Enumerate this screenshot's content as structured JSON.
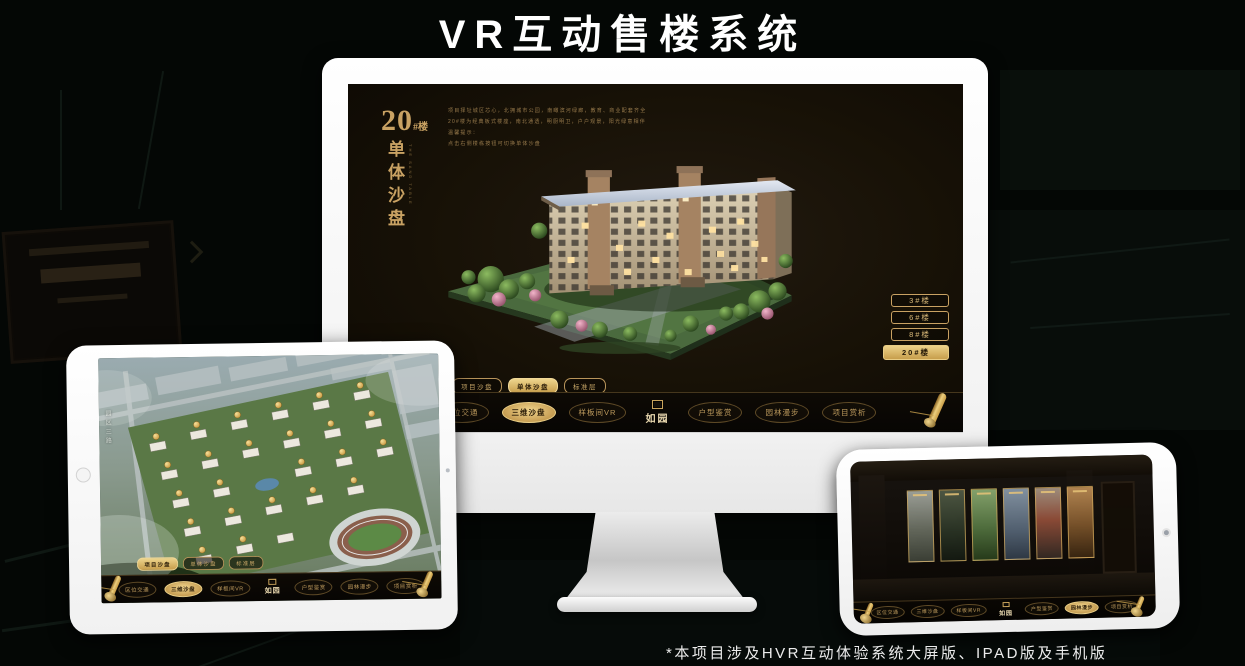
{
  "page": {
    "title": "VR互动售楼系统",
    "footnote": "*本项目涉及HVR互动体验系统大屏版、IPAD版及手机版"
  },
  "brand": {
    "logo_text": "如园",
    "gold": "#c9a263",
    "gold_bright": "#ecd189"
  },
  "monitor": {
    "app": {
      "heading_number": "20",
      "heading_unit": "#楼",
      "heading_vertical": "单体沙盘",
      "heading_vertical_en": "THE SAND TABLE",
      "desc_lines": [
        "项目择址城区芯心，北拥城市公园，南瞰滨河绿廊，教育、商业配套齐全",
        "20#楼为经典板式楼座，南北通透，明厨明卫，户户观景，阳光绿意相伴",
        "温馨提示：",
        "点击右侧楼栋按钮可切换单体沙盘"
      ],
      "floor_buttons": [
        {
          "label": "3#楼",
          "active": false
        },
        {
          "label": "6#楼",
          "active": false
        },
        {
          "label": "8#楼",
          "active": false
        },
        {
          "label": "20#楼",
          "active": true
        }
      ],
      "sub_tabs": [
        {
          "label": "项目沙盘",
          "active": false
        },
        {
          "label": "单体沙盘",
          "active": true
        },
        {
          "label": "标准层",
          "active": false
        }
      ],
      "nav": [
        {
          "label": "区位交通",
          "active": false
        },
        {
          "label": "三维沙盘",
          "active": true
        },
        {
          "label": "样板间VR",
          "active": false
        },
        {
          "label": "户型鉴赏",
          "active": false
        },
        {
          "label": "园林漫步",
          "active": false
        },
        {
          "label": "项目赏析",
          "active": false
        }
      ]
    }
  },
  "tablet": {
    "app": {
      "road_label": "园区三路",
      "sub_tabs": [
        {
          "label": "项目沙盘",
          "active": true
        },
        {
          "label": "单体沙盘",
          "active": false
        },
        {
          "label": "标准层",
          "active": false
        }
      ],
      "nav": [
        {
          "label": "区位交通",
          "active": false
        },
        {
          "label": "三维沙盘",
          "active": true
        },
        {
          "label": "样板间VR",
          "active": false
        },
        {
          "label": "户型鉴赏",
          "active": false
        },
        {
          "label": "园林漫步",
          "active": false
        },
        {
          "label": "项目赏析",
          "active": false
        }
      ]
    }
  },
  "phone": {
    "app": {
      "nav": [
        {
          "label": "区位交通",
          "active": false
        },
        {
          "label": "三维沙盘",
          "active": false
        },
        {
          "label": "样板间VR",
          "active": false
        },
        {
          "label": "户型鉴赏",
          "active": false
        },
        {
          "label": "园林漫步",
          "active": true
        },
        {
          "label": "项目赏析",
          "active": false
        }
      ]
    }
  }
}
